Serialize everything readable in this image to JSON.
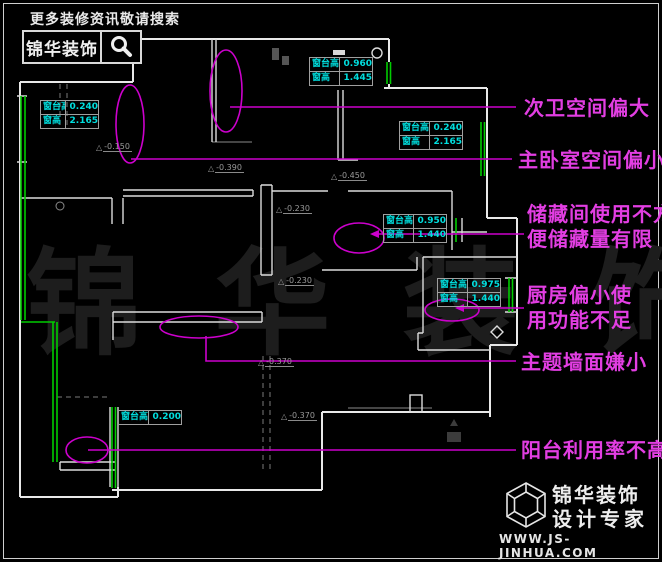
{
  "header": {
    "search_hint": "更多装修资讯敬请搜索",
    "brand": "锦华装饰"
  },
  "watermark": "锦 华 装 饰",
  "callouts": [
    {
      "lines": [
        "次卫空间偏大"
      ]
    },
    {
      "lines": [
        "主卧室空间偏小"
      ]
    },
    {
      "lines": [
        "储藏间使用不方",
        "便储藏量有限"
      ]
    },
    {
      "lines": [
        "厨房偏小使",
        "用功能不足"
      ]
    },
    {
      "lines": [
        "主题墙面嫌小"
      ]
    },
    {
      "lines": [
        "阳台利用率不高"
      ]
    }
  ],
  "measurements": [
    {
      "rows": [
        {
          "label": "窗台高",
          "value": "0.240"
        },
        {
          "label": "窗高",
          "value": "2.165"
        }
      ]
    },
    {
      "rows": [
        {
          "label": "窗台高",
          "value": "0.960"
        },
        {
          "label": "窗高",
          "value": "1.445"
        }
      ]
    },
    {
      "rows": [
        {
          "label": "窗台高",
          "value": "0.240"
        },
        {
          "label": "窗高",
          "value": "2.165"
        }
      ]
    },
    {
      "rows": [
        {
          "label": "窗台高",
          "value": "0.950"
        },
        {
          "label": "窗高",
          "value": "1.440"
        }
      ]
    },
    {
      "rows": [
        {
          "label": "窗台高",
          "value": "0.975"
        },
        {
          "label": "窗高",
          "value": "1.440"
        }
      ]
    },
    {
      "rows": [
        {
          "label": "窗台高",
          "value": "0.200"
        }
      ]
    }
  ],
  "level_markers": [
    "-0.150",
    "-0.390",
    "-0.450",
    "-0.230",
    "-0.230",
    "-0.370",
    "-0.370"
  ],
  "footer": {
    "brand": "锦华装饰",
    "tagline": "设计专家",
    "website": "WWW.JS-JINHUA.COM"
  },
  "colors": {
    "background": "#000000",
    "walls": "#e8e8e8",
    "windows": "#00cc00",
    "callout_line": "#cc00cc",
    "callout_text": "#e23ee2",
    "measurement_text": "#00dede",
    "watermark": "#1d1d1d",
    "logo_text": "#ededed"
  }
}
